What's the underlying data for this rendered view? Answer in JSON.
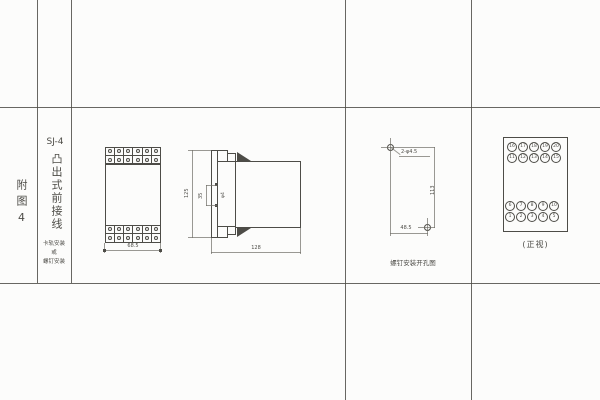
{
  "colors": {
    "ink": "#4d4c47",
    "paper": "#fcfcfb"
  },
  "title_block": {
    "figure_label": "附图4",
    "model": "SJ-4",
    "wiring_type": "凸出式前接线",
    "mounting_note": [
      "卡轨安装",
      "或",
      "螺钉安装"
    ]
  },
  "front_view": {
    "terminal_cols": 6,
    "width_dim": "68.5"
  },
  "side_view": {
    "height_dim": "125",
    "hole_pitch_dim": "35",
    "hole_dia_label": "φ4",
    "depth_dim": "128"
  },
  "drill_view": {
    "holes_label": "2-φ4.5",
    "height_dim": "113",
    "width_dim": "48.5",
    "caption": "螺钉安装开孔图"
  },
  "terminal_view": {
    "caption": "(正视)",
    "top_rows": [
      [
        "16",
        "17",
        "18",
        "19",
        "20"
      ],
      [
        "11",
        "12",
        "13",
        "14",
        "15"
      ]
    ],
    "bottom_rows": [
      [
        "6",
        "7",
        "8",
        "9",
        "10"
      ],
      [
        "1",
        "2",
        "3",
        "4",
        "5"
      ]
    ]
  }
}
